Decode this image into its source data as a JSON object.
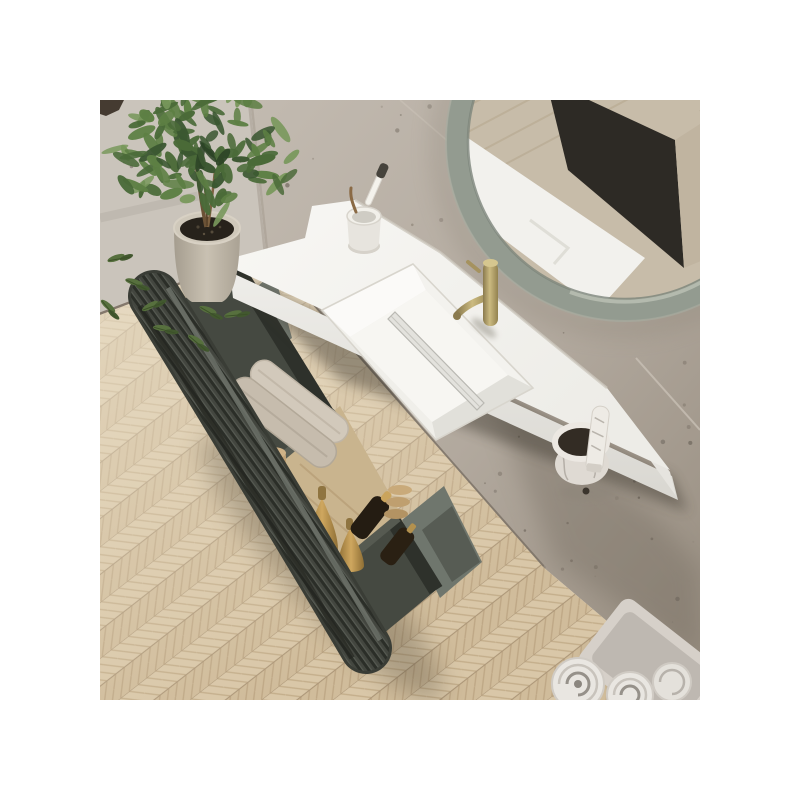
{
  "meta": {
    "type": "product-photo",
    "subject": "Wall-hung bathroom vanity with open fluted drawer, integrated white basin, brass tap and round sage mirror on a concrete wall over herringbone oak floor",
    "canvas": {
      "width": 800,
      "height": 800,
      "margin_color": "#ffffff"
    },
    "photo_area": {
      "x": 100,
      "y": 100,
      "width": 600,
      "height": 600
    }
  },
  "scene": {
    "objects": [
      "concrete-wall",
      "side-wall",
      "herringbone-floor",
      "round-mirror",
      "vanity-countertop",
      "integrated-sink",
      "drain-cover",
      "brass-faucet",
      "toothbrush-cup",
      "marble-jar",
      "cosmetic-tube",
      "open-drawer",
      "fluted-drawer-front",
      "drawer-towels",
      "drawer-bottles",
      "vanity-cabinet",
      "potted-plant",
      "fallen-leaves",
      "towel-tray",
      "rolled-towels"
    ],
    "palette": {
      "wall_light": "#cac4bb",
      "wall_main_top": "#c2bab0",
      "wall_main_bottom": "#988e81",
      "baseboard": "#84786c",
      "floor_plank_a": "#d9c7a8",
      "floor_plank_b": "#d0bc9a",
      "floor_seam": "#ab9577",
      "counter_white": "#f6f5f2",
      "counter_shade": "#e8e7e2",
      "basin_shadow": "#e3e2dd",
      "faucet_brass_light": "#c9b87e",
      "faucet_brass_dark": "#8a7a4e",
      "mirror_frame": "#939b90",
      "mirror_reflection_wood": "#c7bca9",
      "mirror_reflection_dark": "#2d2a25",
      "drawer_front": "#43463f",
      "drawer_front_ridge": "#2b2e28",
      "drawer_interior": "#454941",
      "cabinet_green_grey": "#747b72",
      "towel_beige": "#cfc6b8",
      "towel_roll_white": "#e9e6e1",
      "bottle_gold": "#b98f4d",
      "bottle_amber_dark": "#241c12",
      "bamboo": "#c2a478",
      "plant_green_dark": "#2c4426",
      "plant_green_light": "#79985c",
      "pot_concrete": "#bcb4a6",
      "soil": "#27221b",
      "tray_grey": "#d6d0c9"
    },
    "decor": {
      "foliage": {
        "count": 120,
        "cx": 105,
        "cy": 52,
        "rx": 92,
        "ry": 66,
        "colors": [
          "#2c4426",
          "#3a5630",
          "#4a6a38",
          "#5d7f44",
          "#79985c"
        ]
      },
      "speckles": {
        "zones": [
          [
            170,
            5,
            420,
            200,
            26
          ],
          [
            340,
            230,
            255,
            170,
            20
          ],
          [
            420,
            420,
            175,
            175,
            26
          ],
          [
            15,
            10,
            130,
            90,
            7
          ]
        ],
        "colors": [
          "#8d8478",
          "#6e665c",
          "#7b7268"
        ]
      },
      "reflection_lines": {
        "count": 9,
        "spacing": 26,
        "color": "#b4a68d"
      }
    }
  }
}
